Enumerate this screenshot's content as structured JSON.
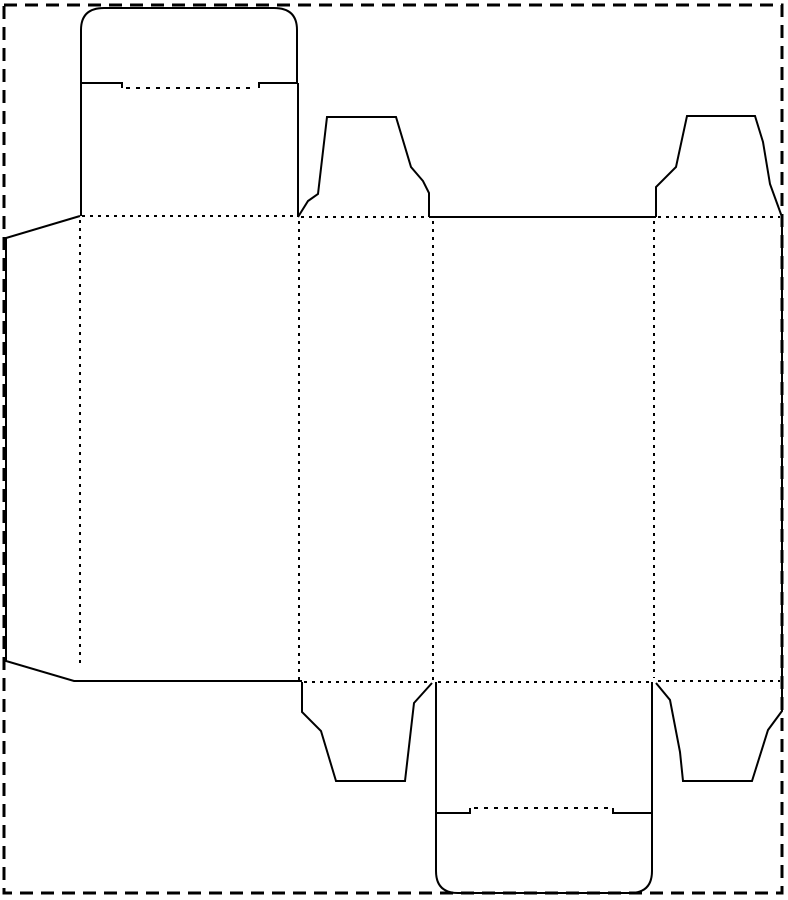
{
  "canvas": {
    "width": 788,
    "height": 900,
    "background_color": "#ffffff",
    "line_color": "#000000"
  },
  "page_border": {
    "x": 4,
    "y": 5,
    "width": 778,
    "height": 888,
    "dash": "13 8",
    "stroke_width": 3
  },
  "styles": {
    "cut": {
      "dash": "",
      "stroke_width": 2
    },
    "fold": {
      "dash": "3 5",
      "stroke_width": 2
    },
    "tuck_fold": {
      "dash": "4 6",
      "stroke_width": 2
    }
  },
  "paths": [
    {
      "name": "glue-flap-outline",
      "kind": "cut",
      "d": "M 80 216 L 6 238 L 6 661 L 74 681 L 302 681"
    },
    {
      "name": "front-panel-left-edge",
      "kind": "cut",
      "d": "M 81 83 L 81 216"
    },
    {
      "name": "front-panel-right-edge",
      "kind": "cut",
      "d": "M 298 83 L 298 217"
    },
    {
      "name": "tuck-lid-top-outline",
      "kind": "cut",
      "d": "M 81 83 L 81 30 Q 81 8 104 8 L 274 8 Q 297 8 297 30 L 297 83"
    },
    {
      "name": "tuck-lid-top-shoulder-left",
      "kind": "cut",
      "d": "M 81 83 L 122 83 L 122 88"
    },
    {
      "name": "tuck-lid-top-shoulder-right",
      "kind": "cut",
      "d": "M 298 83 L 259 83 L 259 88"
    },
    {
      "name": "dust-flap-top-left-outline",
      "kind": "cut",
      "d": "M 298 217 L 308 201 L 318 194 L 327 117 L 396 117 L 411 167 L 423 181 L 429 193 L 429 217"
    },
    {
      "name": "center-panel-top-edge",
      "kind": "cut",
      "d": "M 429 217 L 656 217"
    },
    {
      "name": "dust-flap-top-right-outline",
      "kind": "cut",
      "d": "M 656 217 L 656 187 L 676 167 L 687 116 L 755 116 L 763 142 L 770 184 L 782 217"
    },
    {
      "name": "right-panel-right-edge",
      "kind": "cut",
      "d": "M 782 217 L 782 682"
    },
    {
      "name": "dust-flap-bottom-right-outline",
      "kind": "cut",
      "d": "M 782 682 L 782 711 L 768 730 L 752 781 L 683 781 L 680 752 L 670 700 L 656 683"
    },
    {
      "name": "dust-flap-bottom-left-outline",
      "kind": "cut",
      "d": "M 302 682 L 302 712 L 321 731 L 336 781 L 405 781 L 414 703 L 432 683"
    },
    {
      "name": "tuck-flap-bottom-left-edge",
      "kind": "cut",
      "d": "M 436 682 L 436 813"
    },
    {
      "name": "tuck-flap-bottom-right-edge",
      "kind": "cut",
      "d": "M 652 682 L 652 813"
    },
    {
      "name": "tuck-lid-bottom-shoulder-left",
      "kind": "cut",
      "d": "M 436 813 L 470 813 L 470 808"
    },
    {
      "name": "tuck-lid-bottom-shoulder-right",
      "kind": "cut",
      "d": "M 652 813 L 613 813 L 613 808"
    },
    {
      "name": "tuck-lid-bottom-outline",
      "kind": "cut",
      "d": "M 436 813 L 436 871 Q 436 893 458 893 L 630 893 Q 652 893 652 871 L 652 813"
    },
    {
      "name": "fold-top-front-panel",
      "kind": "fold",
      "d": "M 82 216 L 297 216"
    },
    {
      "name": "fold-top-left-dust-flap",
      "kind": "fold",
      "d": "M 301 217 L 428 217"
    },
    {
      "name": "fold-top-right-dust-flap",
      "kind": "fold",
      "d": "M 658 217 L 780 217"
    },
    {
      "name": "fold-bottom-left-dust-flap",
      "kind": "fold",
      "d": "M 304 682 L 431 682"
    },
    {
      "name": "fold-bottom-tuck-flap",
      "kind": "fold",
      "d": "M 438 682 L 650 682"
    },
    {
      "name": "fold-bottom-right-dust-flap",
      "kind": "fold",
      "d": "M 658 681 L 780 681"
    },
    {
      "name": "fold-glue-flap",
      "kind": "fold",
      "d": "M 80 220 L 80 667"
    },
    {
      "name": "fold-front-side-panels",
      "kind": "fold",
      "d": "M 299 221 L 299 680"
    },
    {
      "name": "fold-side-center-panels",
      "kind": "fold",
      "d": "M 433 221 L 433 680"
    },
    {
      "name": "fold-center-right-panels",
      "kind": "fold",
      "d": "M 654 221 L 654 678"
    },
    {
      "name": "tuck-fold-top",
      "kind": "tuck_fold",
      "d": "M 126 88 L 256 88"
    },
    {
      "name": "tuck-fold-bottom",
      "kind": "tuck_fold",
      "d": "M 474 808 L 610 808"
    }
  ]
}
